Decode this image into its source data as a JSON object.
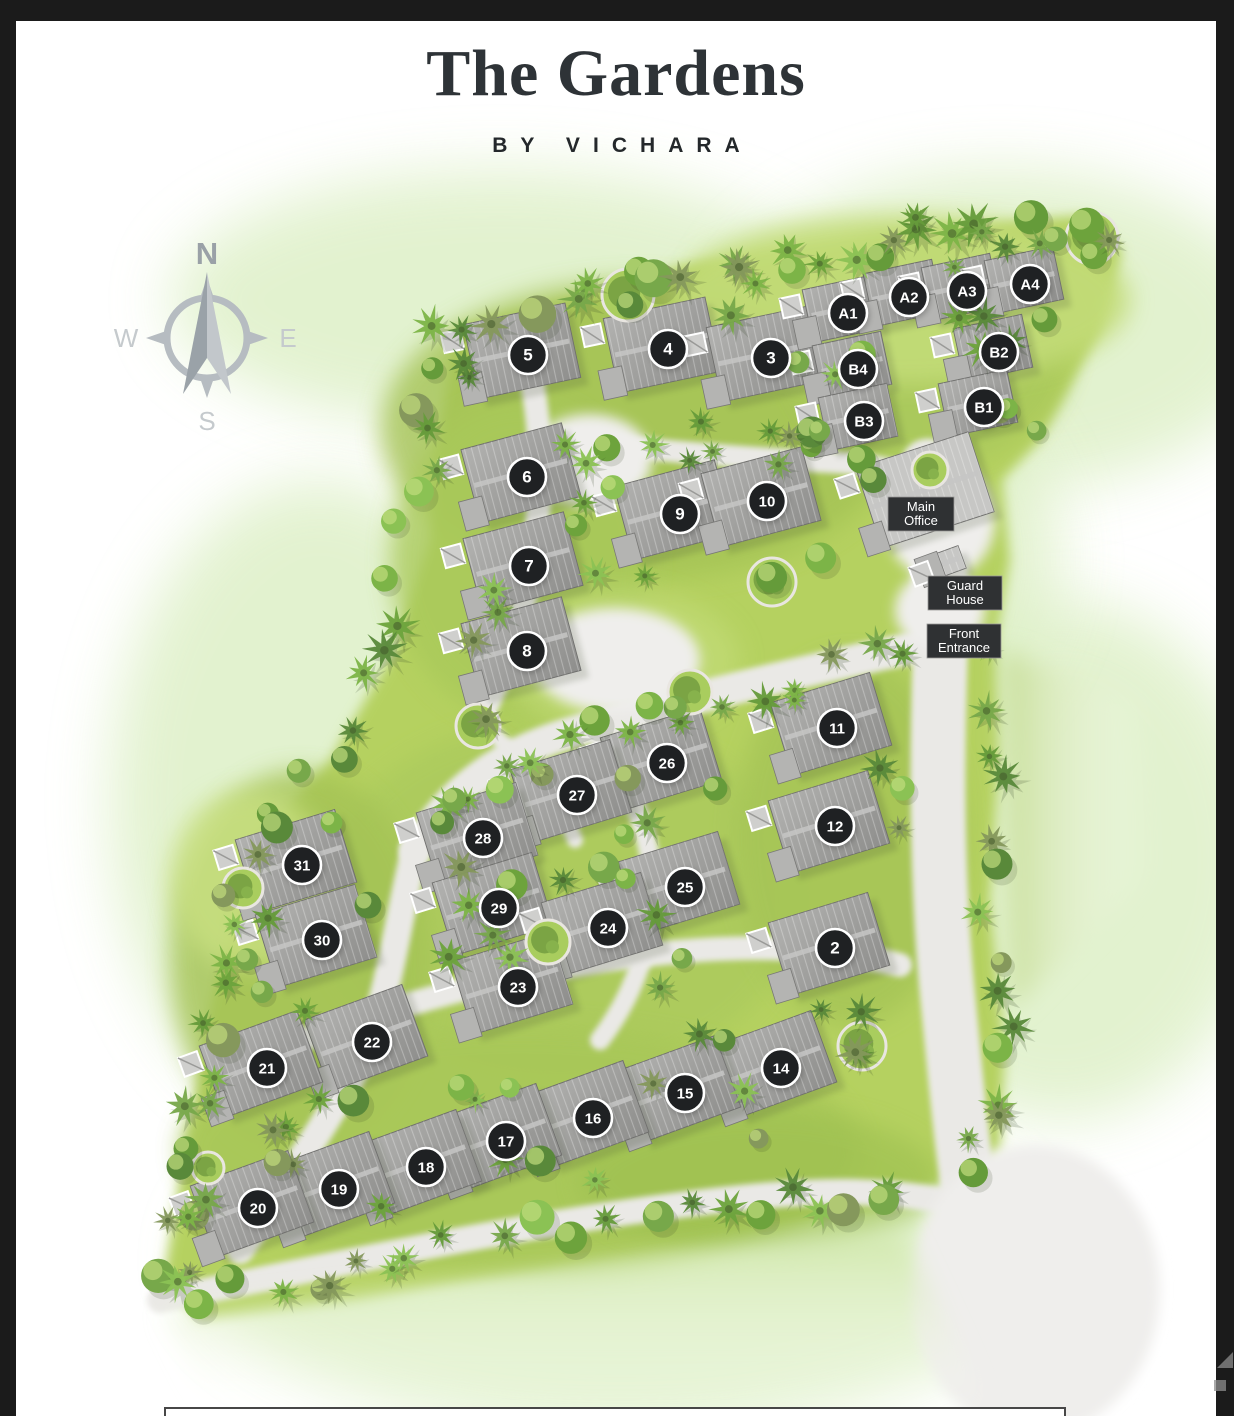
{
  "page": {
    "title": "The Gardens",
    "subtitle": "BY VICHARA"
  },
  "compass": {
    "north": "N",
    "west": "W",
    "east": "E",
    "south": "S"
  },
  "map": {
    "lots": [
      {
        "id": "5",
        "x": 528,
        "y": 355
      },
      {
        "id": "4",
        "x": 668,
        "y": 349
      },
      {
        "id": "3",
        "x": 771,
        "y": 358
      },
      {
        "id": "A1",
        "x": 848,
        "y": 313
      },
      {
        "id": "A2",
        "x": 909,
        "y": 297
      },
      {
        "id": "A3",
        "x": 967,
        "y": 291
      },
      {
        "id": "A4",
        "x": 1030,
        "y": 284
      },
      {
        "id": "B4",
        "x": 858,
        "y": 369
      },
      {
        "id": "B2",
        "x": 999,
        "y": 352
      },
      {
        "id": "B3",
        "x": 864,
        "y": 421
      },
      {
        "id": "B1",
        "x": 984,
        "y": 407
      },
      {
        "id": "6",
        "x": 527,
        "y": 477
      },
      {
        "id": "9",
        "x": 680,
        "y": 514
      },
      {
        "id": "10",
        "x": 767,
        "y": 501
      },
      {
        "id": "7",
        "x": 529,
        "y": 566
      },
      {
        "id": "8",
        "x": 527,
        "y": 651
      },
      {
        "id": "11",
        "x": 837,
        "y": 728
      },
      {
        "id": "26",
        "x": 667,
        "y": 763
      },
      {
        "id": "27",
        "x": 577,
        "y": 795
      },
      {
        "id": "12",
        "x": 835,
        "y": 826
      },
      {
        "id": "28",
        "x": 483,
        "y": 838
      },
      {
        "id": "31",
        "x": 302,
        "y": 865
      },
      {
        "id": "25",
        "x": 685,
        "y": 887
      },
      {
        "id": "29",
        "x": 499,
        "y": 908
      },
      {
        "id": "24",
        "x": 608,
        "y": 928
      },
      {
        "id": "30",
        "x": 322,
        "y": 940
      },
      {
        "id": "2",
        "x": 835,
        "y": 948
      },
      {
        "id": "23",
        "x": 518,
        "y": 987
      },
      {
        "id": "22",
        "x": 372,
        "y": 1042
      },
      {
        "id": "21",
        "x": 267,
        "y": 1068
      },
      {
        "id": "14",
        "x": 781,
        "y": 1068
      },
      {
        "id": "15",
        "x": 685,
        "y": 1093
      },
      {
        "id": "16",
        "x": 593,
        "y": 1118
      },
      {
        "id": "17",
        "x": 506,
        "y": 1141
      },
      {
        "id": "18",
        "x": 426,
        "y": 1167
      },
      {
        "id": "19",
        "x": 339,
        "y": 1189
      },
      {
        "id": "20",
        "x": 258,
        "y": 1208
      }
    ],
    "places": [
      {
        "id": "main-office",
        "lines": [
          "Main",
          "Office"
        ],
        "x": 921,
        "y": 514,
        "w": 66,
        "h": 34
      },
      {
        "id": "guard-house",
        "lines": [
          "Guard",
          "House"
        ],
        "x": 965,
        "y": 593,
        "w": 74,
        "h": 34
      },
      {
        "id": "front-entrance",
        "lines": [
          "Front",
          "Entrance"
        ],
        "x": 964,
        "y": 641,
        "w": 74,
        "h": 34
      }
    ]
  },
  "colors": {
    "marker_bg": "#1f2123",
    "marker_text": "#ffffff",
    "label_bg": "#2f3133",
    "label_text": "#ffffff",
    "grass": "#b5d161",
    "tree_green": "#7cb447",
    "road": "#eae9e6",
    "roof": "#9c9c9a"
  }
}
